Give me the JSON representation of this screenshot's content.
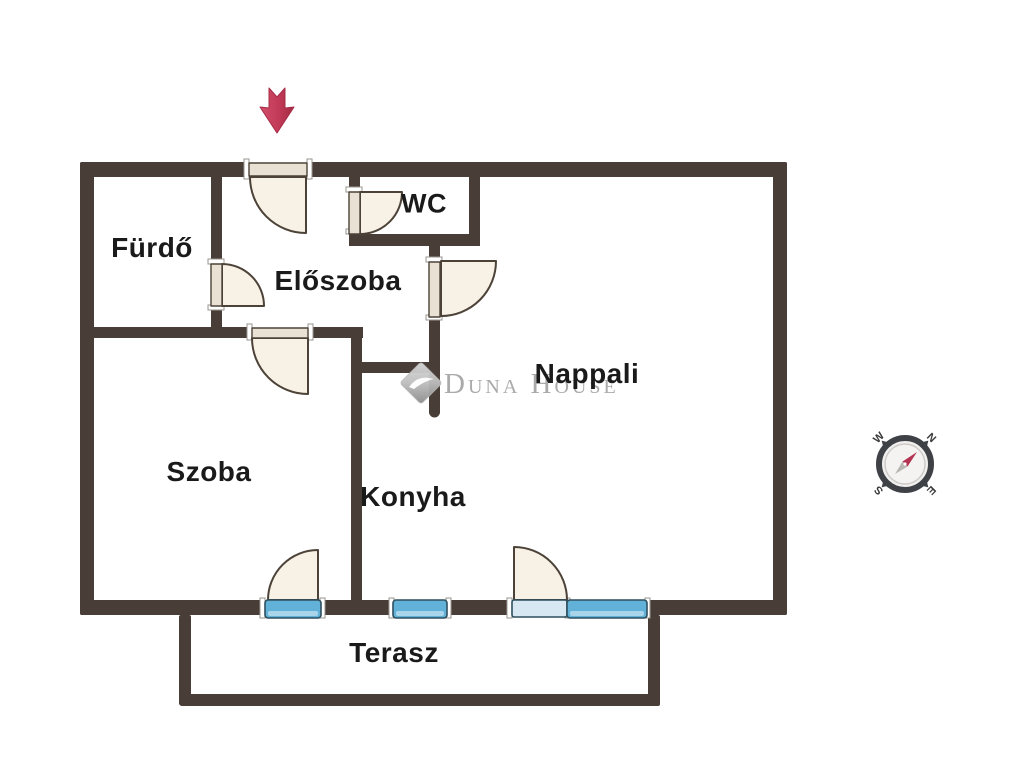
{
  "colors": {
    "wall": "#493e37",
    "door_arc_fill": "#f8f2e6",
    "door_slab": "#e9e2d4",
    "window_blue": "#62b1d9",
    "window_blue_light": "#a9d5ea",
    "balcony_sill_light_blue": "#d7e8f2",
    "entrance_arrow_red": "#c23a58",
    "watermark_gray": "#a3a3a3",
    "compass_needle_red": "#b53352",
    "label_text": "#1a1a1a"
  },
  "rooms": {
    "furdo": "Fürdő",
    "eloszoba": "Előszoba",
    "wc": "WC",
    "nappali": "Nappali",
    "szoba": "Szoba",
    "konyha": "Konyha",
    "terasz": "Terasz"
  },
  "watermark": {
    "text": "Duna House"
  },
  "compass": {
    "north": "N",
    "south": "S",
    "east": "E",
    "west": "W"
  }
}
